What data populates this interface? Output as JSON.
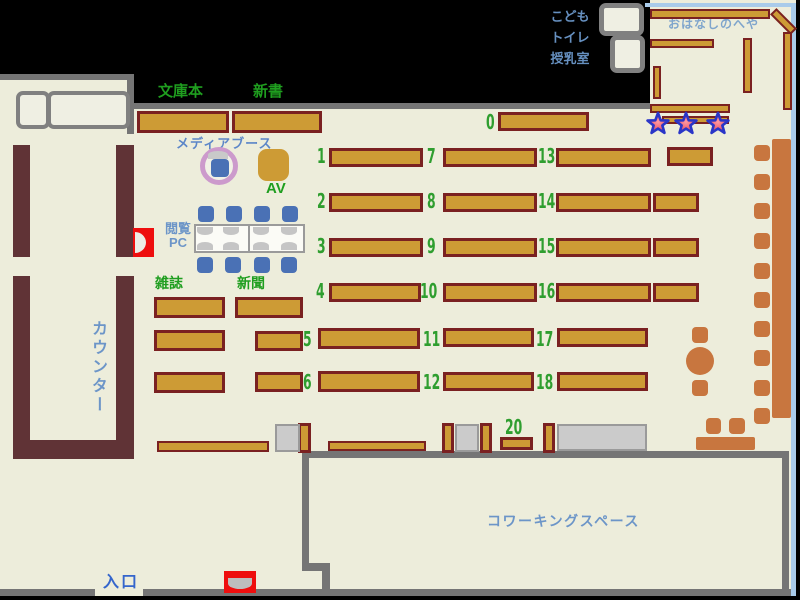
{
  "map": {
    "title_implicit": "library floor map",
    "rooms": {
      "storytelling": "おはなしのへや",
      "coworking": "コワーキングスペース",
      "counter": "カウンター",
      "entrance": "入口",
      "kids": "こども",
      "toilet": "トイレ",
      "nursing": "授乳室",
      "media_booth": "メディアブース"
    },
    "sections": {
      "paperbacks": "文庫本",
      "new_books": "新書",
      "av": "AV",
      "magazines": "雑誌",
      "newspapers": "新聞",
      "browsing_pc_line1": "閲覧",
      "browsing_pc_line2": "PC"
    },
    "shelf_numbers": [
      "0",
      "1",
      "2",
      "3",
      "4",
      "5",
      "6",
      "7",
      "8",
      "9",
      "10",
      "11",
      "12",
      "13",
      "14",
      "15",
      "16",
      "17",
      "18",
      "20"
    ],
    "colors": {
      "floor": "#EDEDDB",
      "wall_gray": "#757575",
      "wall_blue": "#A9CBEA",
      "shelf_fill": "#CD9B35",
      "shelf_border": "#7A2121",
      "counter_brown": "#603336",
      "chair_blue": "#4A71B5",
      "furniture_orange": "#C8763F",
      "label_green": "#1F9E1F",
      "label_blue": "#6C95C8",
      "alert_red": "#EE0E0E",
      "ring_purple": "#CC9ACC",
      "star_fill": "#E8485A",
      "star_stroke": "#2A35C8"
    }
  }
}
